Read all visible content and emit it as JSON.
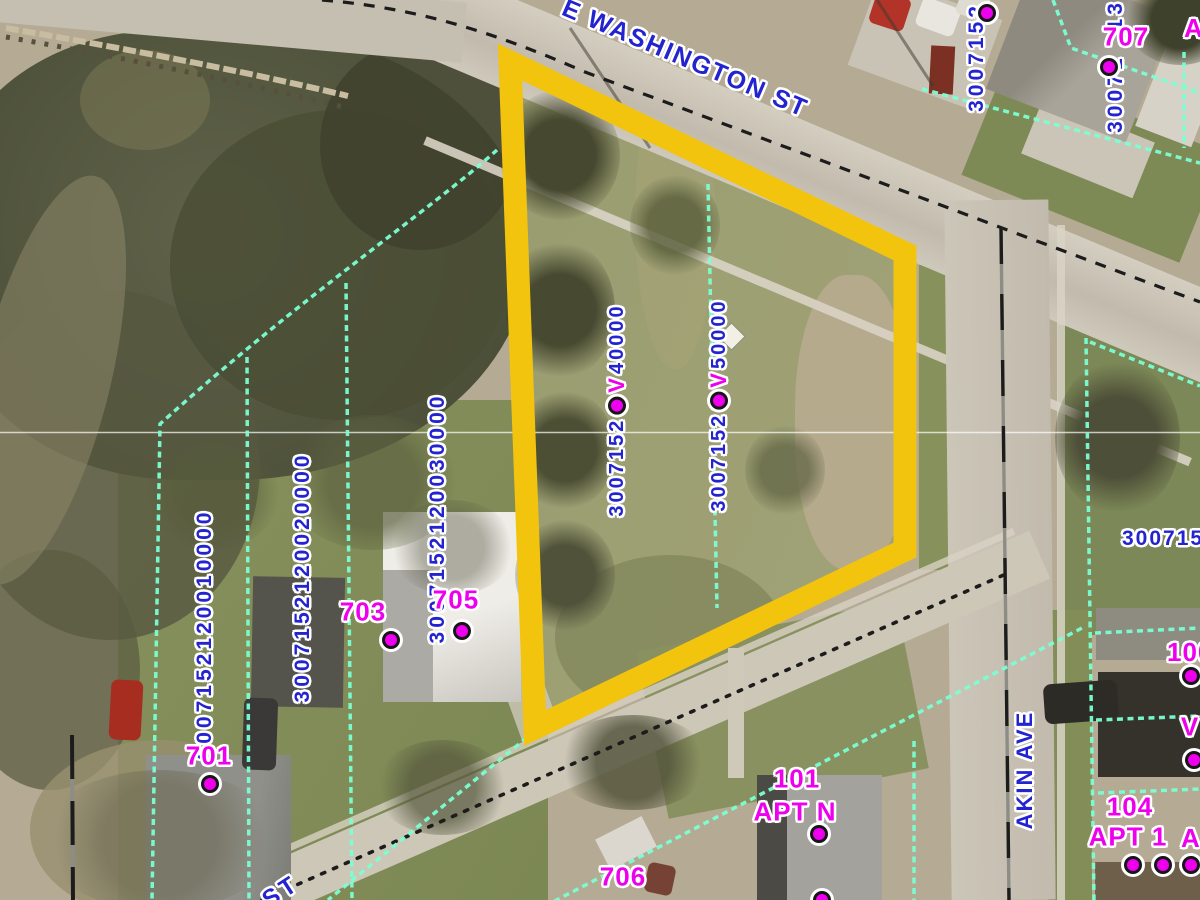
{
  "map": {
    "colors": {
      "selection_yellow": "#F2C40E",
      "parcel_line_cyan": "#7BFFD2",
      "parcel_label_blue": "#2323D0",
      "address_label_magenta": "#EE00EE"
    },
    "streets": {
      "main": "E WASHINGTON ST",
      "side": "AKIN AVE",
      "fragment": "ST"
    },
    "parcel_labels": {
      "top_left_vertical": "3007152",
      "top_right_bottom": "30071",
      "top_right_top": "13",
      "sel_left_prefix": "3007152",
      "sel_left_marker": "V",
      "sel_left_suffix": "40000",
      "sel_right_prefix": "3007152",
      "sel_right_marker": "V",
      "sel_right_suffix": "50000",
      "lot3": "3007152120030000",
      "lot2": "3007152120020000",
      "lot1": "3007152120010000",
      "right_edge": "300715"
    },
    "addresses": {
      "a707": "707",
      "a705": "705",
      "a703": "703",
      "a701": "701",
      "a706": "706",
      "a101_line1": "101",
      "a101_line2": "APT N",
      "a104_line1": "104",
      "a104_line2": "APT 1",
      "a100": "100",
      "vacant_marker": "V",
      "apt_cut_top": "A",
      "apt_cut_bottom": "A"
    }
  }
}
